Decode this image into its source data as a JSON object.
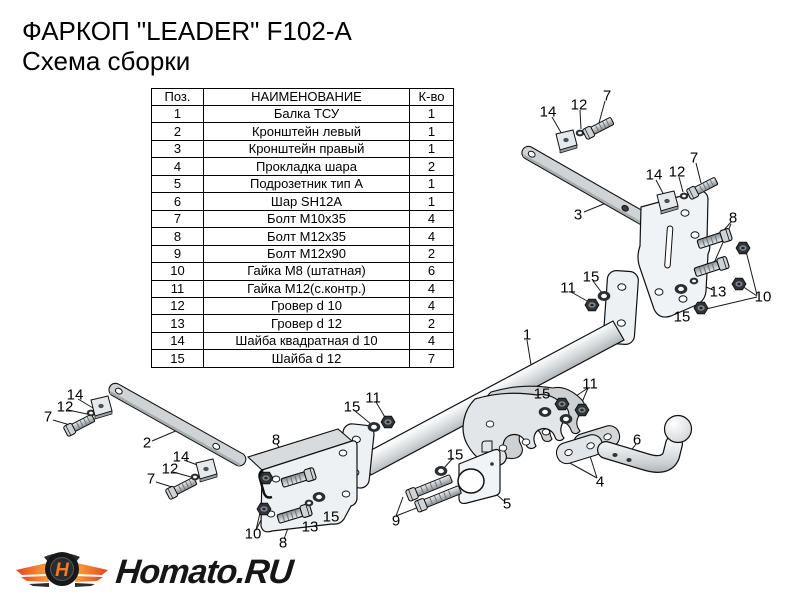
{
  "title": {
    "line1": "ФАРКОП \"LEADER\" F102-A",
    "line2": "Схема сборки"
  },
  "parts_table": {
    "headers": [
      "Поз.",
      "НАИМЕНОВАНИЕ",
      "К-во"
    ],
    "rows": [
      [
        "1",
        "Балка ТСУ",
        "1"
      ],
      [
        "2",
        "Кронштейн левый",
        "1"
      ],
      [
        "3",
        "Кронштейн правый",
        "1"
      ],
      [
        "4",
        "Прокладка шара",
        "2"
      ],
      [
        "5",
        "Подрозетник тип А",
        "1"
      ],
      [
        "6",
        "Шар SH12A",
        "1"
      ],
      [
        "7",
        "Болт М10х35",
        "4"
      ],
      [
        "8",
        "Болт М12х35",
        "4"
      ],
      [
        "9",
        "Болт М12х90",
        "2"
      ],
      [
        "10",
        "Гайка М8 (штатная)",
        "6"
      ],
      [
        "11",
        "Гайка М12(с.контр.)",
        "4"
      ],
      [
        "12",
        "Гровер d 10",
        "4"
      ],
      [
        "13",
        "Гровер d 12",
        "2"
      ],
      [
        "14",
        "Шайба квадратная d 10",
        "4"
      ],
      [
        "15",
        "Шайба d 12",
        "7"
      ]
    ]
  },
  "diagram": {
    "callouts": [
      {
        "label": "14",
        "x": 548,
        "y": 112
      },
      {
        "label": "12",
        "x": 579,
        "y": 105
      },
      {
        "label": "7",
        "x": 607,
        "y": 96
      },
      {
        "label": "14",
        "x": 654,
        "y": 175
      },
      {
        "label": "12",
        "x": 677,
        "y": 172
      },
      {
        "label": "7",
        "x": 694,
        "y": 158
      },
      {
        "label": "3",
        "x": 578,
        "y": 215
      },
      {
        "label": "8",
        "x": 733,
        "y": 218
      },
      {
        "label": "13",
        "x": 718,
        "y": 292
      },
      {
        "label": "15",
        "x": 682,
        "y": 317
      },
      {
        "label": "10",
        "x": 763,
        "y": 297
      },
      {
        "label": "11",
        "x": 568,
        "y": 288
      },
      {
        "label": "15",
        "x": 591,
        "y": 277
      },
      {
        "label": "1",
        "x": 527,
        "y": 335
      },
      {
        "label": "15",
        "x": 542,
        "y": 394
      },
      {
        "label": "11",
        "x": 590,
        "y": 384
      },
      {
        "label": "15",
        "x": 352,
        "y": 407
      },
      {
        "label": "11",
        "x": 373,
        "y": 398
      },
      {
        "label": "15",
        "x": 455,
        "y": 455
      },
      {
        "label": "9",
        "x": 396,
        "y": 521
      },
      {
        "label": "5",
        "x": 507,
        "y": 504
      },
      {
        "label": "4",
        "x": 600,
        "y": 482
      },
      {
        "label": "6",
        "x": 637,
        "y": 440
      },
      {
        "label": "2",
        "x": 147,
        "y": 443
      },
      {
        "label": "14",
        "x": 75,
        "y": 395
      },
      {
        "label": "12",
        "x": 65,
        "y": 407
      },
      {
        "label": "7",
        "x": 48,
        "y": 417
      },
      {
        "label": "14",
        "x": 181,
        "y": 457
      },
      {
        "label": "12",
        "x": 170,
        "y": 469
      },
      {
        "label": "7",
        "x": 151,
        "y": 479
      },
      {
        "label": "8",
        "x": 276,
        "y": 440
      },
      {
        "label": "10",
        "x": 253,
        "y": 534
      },
      {
        "label": "8",
        "x": 283,
        "y": 543
      },
      {
        "label": "13",
        "x": 310,
        "y": 527
      },
      {
        "label": "15",
        "x": 331,
        "y": 517
      }
    ]
  },
  "logo": {
    "text": "Homato.RU",
    "emblem_letter": "H"
  },
  "colors": {
    "wing_orange": "#f79a36",
    "wing_red": "#e8431c",
    "metal_light": "#eef1f3",
    "metal_gray": "#cfd3d5",
    "outline": "#111111"
  }
}
